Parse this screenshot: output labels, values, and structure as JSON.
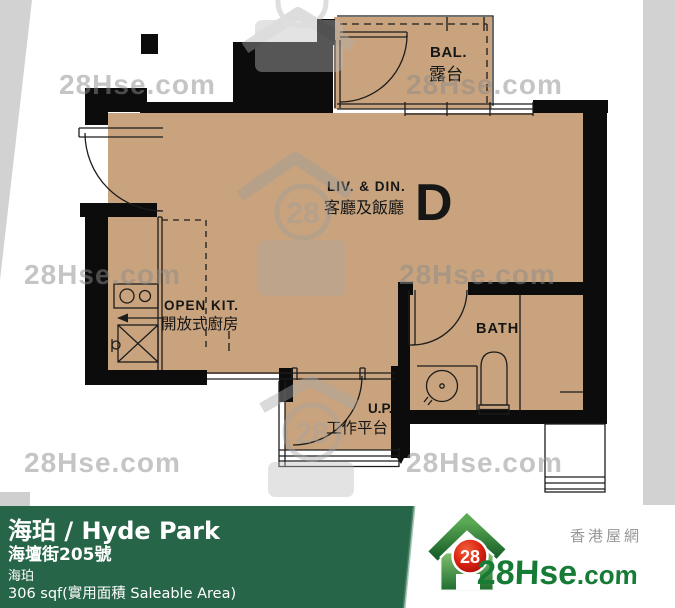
{
  "watermark": {
    "text": "28Hse.com",
    "badge": "28"
  },
  "plan": {
    "unit_letter": "D",
    "balcony_en": "BAL.",
    "balcony_zh": "露台",
    "living_en": "LIV. & DIN.",
    "living_zh": "客廳及飯廳",
    "kitchen_en": "OPEN KIT.",
    "kitchen_zh": "開放式廚房",
    "bath_en": "BATH",
    "up_en": "U.P.",
    "up_zh": "工作平台"
  },
  "footer": {
    "title": "海珀 / Hyde Park",
    "address": "海壇街205號",
    "estate": "海珀",
    "area": "306 sqf(實用面積 Saleable Area)",
    "logo_badge": "28",
    "logo_text_main": "28Hse",
    "logo_text_suffix": ".com",
    "logo_tagline": "香港屋網",
    "colors": {
      "bar": "#276549",
      "logo_green": "#157b35",
      "badge_red": "#cc1b10",
      "plan_floor": "#c8a37d",
      "wall_black": "#0c0c0c"
    }
  }
}
